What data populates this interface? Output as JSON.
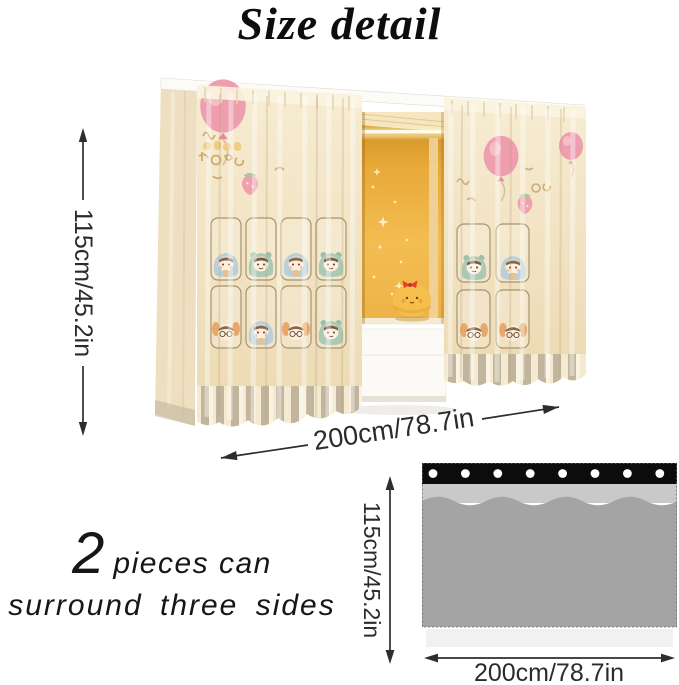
{
  "title": "Size detail",
  "photo": {
    "height_label": "115cm/45.2in",
    "width_label": "200cm/78.7in"
  },
  "note": {
    "count": "2",
    "line1": "pieces can",
    "line2": "surround three sides"
  },
  "panel_diagram": {
    "height_label": "115cm/45.2in",
    "width_label": "200cm/78.7in",
    "grommet_count": 8,
    "pleat_count": 5,
    "colors": {
      "header": "#0c0c0c",
      "band": "#c9c9c9",
      "body": "#a4a4a4",
      "hem": "#f1f1f1",
      "grommet": "#ffffff"
    }
  },
  "colors": {
    "background": "#ffffff",
    "title_text": "#0d0d0d",
    "dimension_text": "#2d2d2d",
    "curtain_cream": "#f2e4c6",
    "interior_glow": "#e9a938",
    "balloon_pink": "#ee9eae"
  }
}
